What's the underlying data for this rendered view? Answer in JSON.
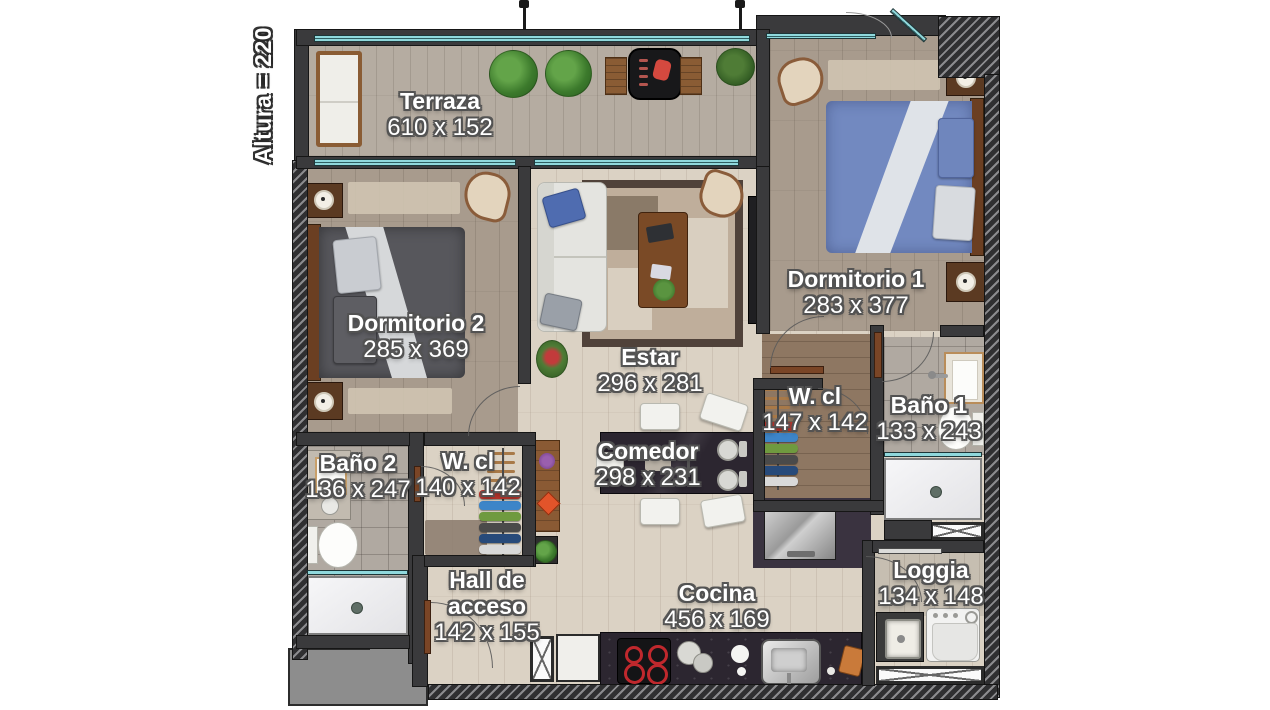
{
  "plan": {
    "altura": "Altura = 220",
    "rooms": {
      "terraza": {
        "name": "Terraza",
        "dims": "610 x 152"
      },
      "dormitorio1": {
        "name": "Dormitorio 1",
        "dims": "283 x 377"
      },
      "dormitorio2": {
        "name": "Dormitorio 2",
        "dims": "285 x 369"
      },
      "estar": {
        "name": "Estar",
        "dims": "296 x 281"
      },
      "wcl1": {
        "name": "W. cl",
        "dims": "147 x 142"
      },
      "bano1": {
        "name": "Baño 1",
        "dims": "133 x 243"
      },
      "bano2": {
        "name": "Baño 2",
        "dims": "136 x 247"
      },
      "wcl2": {
        "name": "W. cl",
        "dims": "140 x 142"
      },
      "comedor": {
        "name": "Comedor",
        "dims": "298 x 231"
      },
      "hall": {
        "name": "Hall de acceso",
        "dims": "142 x 155"
      },
      "cocina": {
        "name": "Cocina",
        "dims": "456 x 169"
      },
      "loggia": {
        "name": "Loggia",
        "dims": "134 x 148"
      }
    },
    "colors": {
      "wall": "#3a3a3c",
      "window_glass": "#8fd8dc",
      "floor_living": "#dbd2c4",
      "floor_bedroom": "#a89b8d",
      "floor_terrace": "#b5aca1",
      "floor_closet": "#8e7762",
      "floor_tile": "#b0a9a1",
      "counter_dark": "#2c2630",
      "bed1_duvet": "#7289c0",
      "bed2_duvet": "#57575c",
      "door_wood": "#7a4526",
      "label_text": "#ffffff"
    }
  }
}
